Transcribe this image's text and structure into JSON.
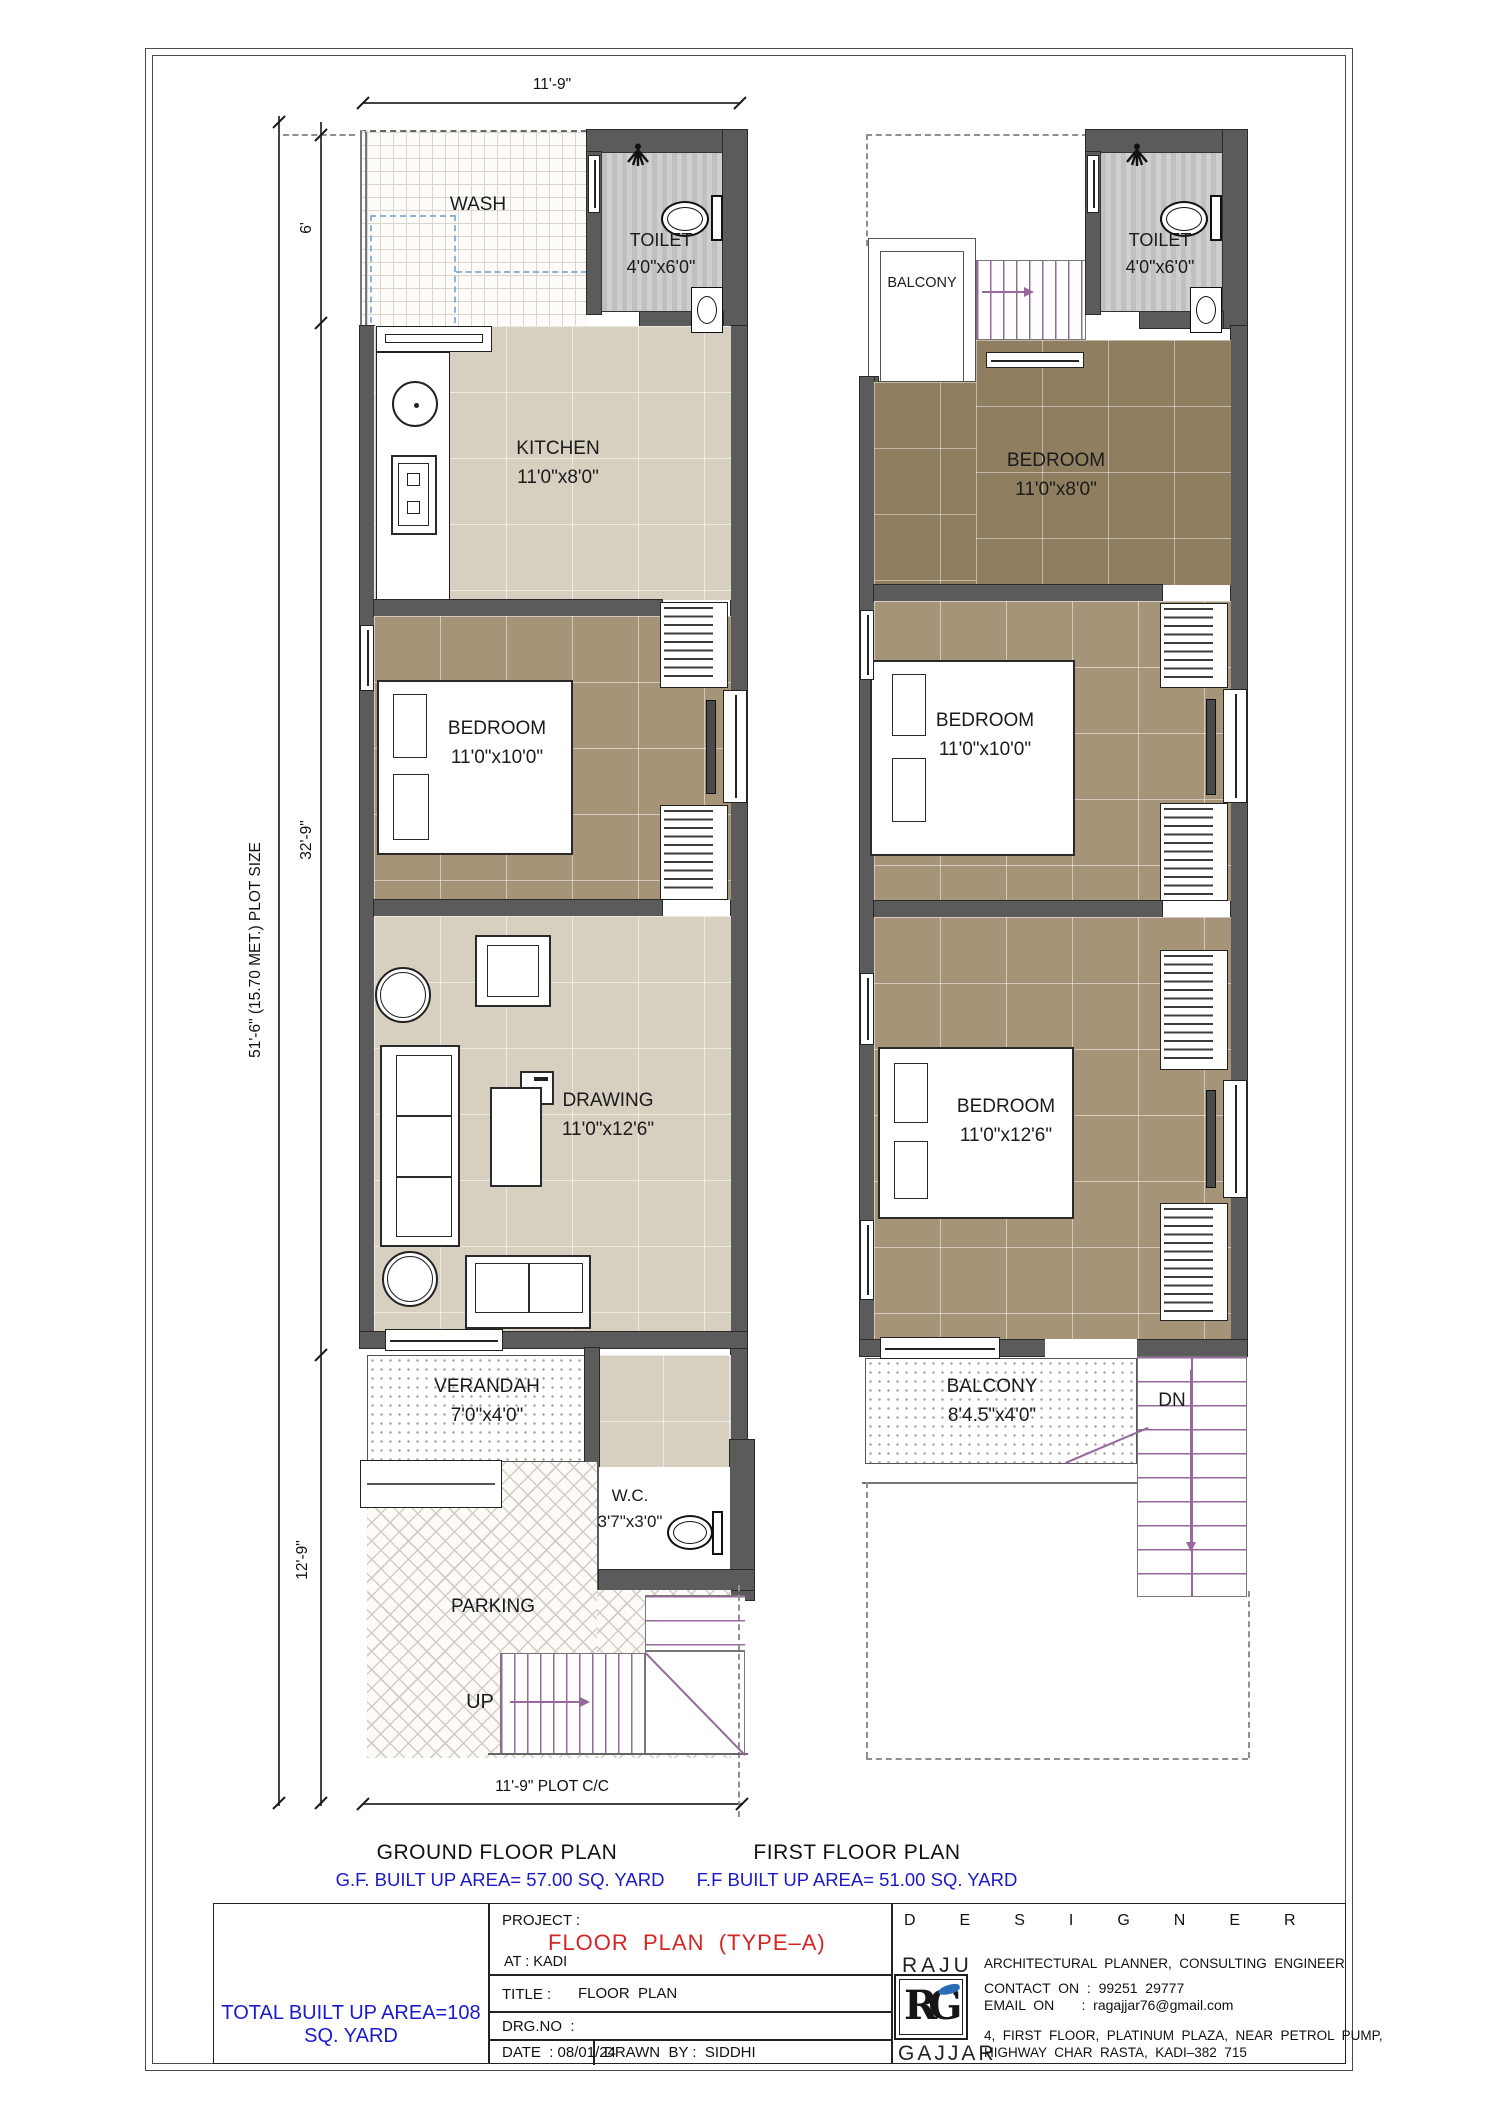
{
  "colors": {
    "wall": "#5b5b5b",
    "floor_beige": "#d7cfc0",
    "floor_brown": "#a69478",
    "floor_dark_brown": "#8f7e60",
    "blue_text": "#1a1acb",
    "red_text": "#d42525",
    "stair_purple": "#96689b",
    "logo_blue": "#2b6cb8"
  },
  "dimensions": {
    "top_width": "11'-9\"",
    "wash_height": "6'",
    "main_height": "32'-9\"",
    "parking_height": "12'-9\"",
    "plot_size": "51'-6\" (15.70 MET.) PLOT SIZE",
    "plot_cc": "11'-9\" PLOT C/C"
  },
  "ground_floor": {
    "title": "GROUND FLOOR PLAN",
    "area": "G.F. BUILT UP AREA= 57.00 SQ. YARD",
    "wash": {
      "name": "WASH"
    },
    "toilet": {
      "name": "TOILET",
      "size": "4'0\"x6'0\""
    },
    "kitchen": {
      "name": "KITCHEN",
      "size": "11'0\"x8'0\""
    },
    "bedroom": {
      "name": "BEDROOM",
      "size": "11'0\"x10'0\""
    },
    "drawing": {
      "name": "DRAWING",
      "size": "11'0\"x12'6\""
    },
    "verandah": {
      "name": "VERANDAH",
      "size": "7'0\"x4'0\""
    },
    "wc": {
      "name": "W.C.",
      "size": "3'7\"x3'0\""
    },
    "parking": {
      "name": "PARKING"
    },
    "up": "UP"
  },
  "first_floor": {
    "title": "FIRST FLOOR PLAN",
    "area": "F.F BUILT UP AREA= 51.00 SQ. YARD",
    "balcony_top": {
      "name": "BALCONY"
    },
    "toilet": {
      "name": "TOILET",
      "size": "4'0\"x6'0\""
    },
    "bedroom1": {
      "name": "BEDROOM",
      "size": "11'0\"x8'0\""
    },
    "bedroom2": {
      "name": "BEDROOM",
      "size": "11'0\"x10'0\""
    },
    "bedroom3": {
      "name": "BEDROOM",
      "size": "11'0\"x12'6\""
    },
    "balcony": {
      "name": "BALCONY",
      "size": "8'4.5\"x4'0\""
    },
    "dn": "DN"
  },
  "title_block": {
    "total_area": "TOTAL BUILT UP AREA=108 SQ. YARD",
    "project_label": "PROJECT :",
    "project_name": "FLOOR  PLAN  (TYPE–A)",
    "project_at": "AT : KADI",
    "title_label": "TITLE :",
    "title_value": "FLOOR  PLAN",
    "drg_label": "DRG.NO  :",
    "date_label": "DATE  : 08/01/24",
    "drawn_label": "DRAWN  BY :  SIDDHI",
    "designer_heading": "DESIGNER",
    "designer_first": "RAJU",
    "designer_last": "GAJJAR",
    "logo": "RG",
    "role": "ARCHITECTURAL  PLANNER,  CONSULTING  ENGINEER",
    "contact": "CONTACT  ON  :  99251  29777",
    "email": "EMAIL  ON       :  ragajjar76@gmail.com",
    "address1": "4,  FIRST  FLOOR,  PLATINUM  PLAZA,  NEAR  PETROL  PUMP,",
    "address2": "HIGHWAY  CHAR  RASTA,  KADI–382  715"
  }
}
